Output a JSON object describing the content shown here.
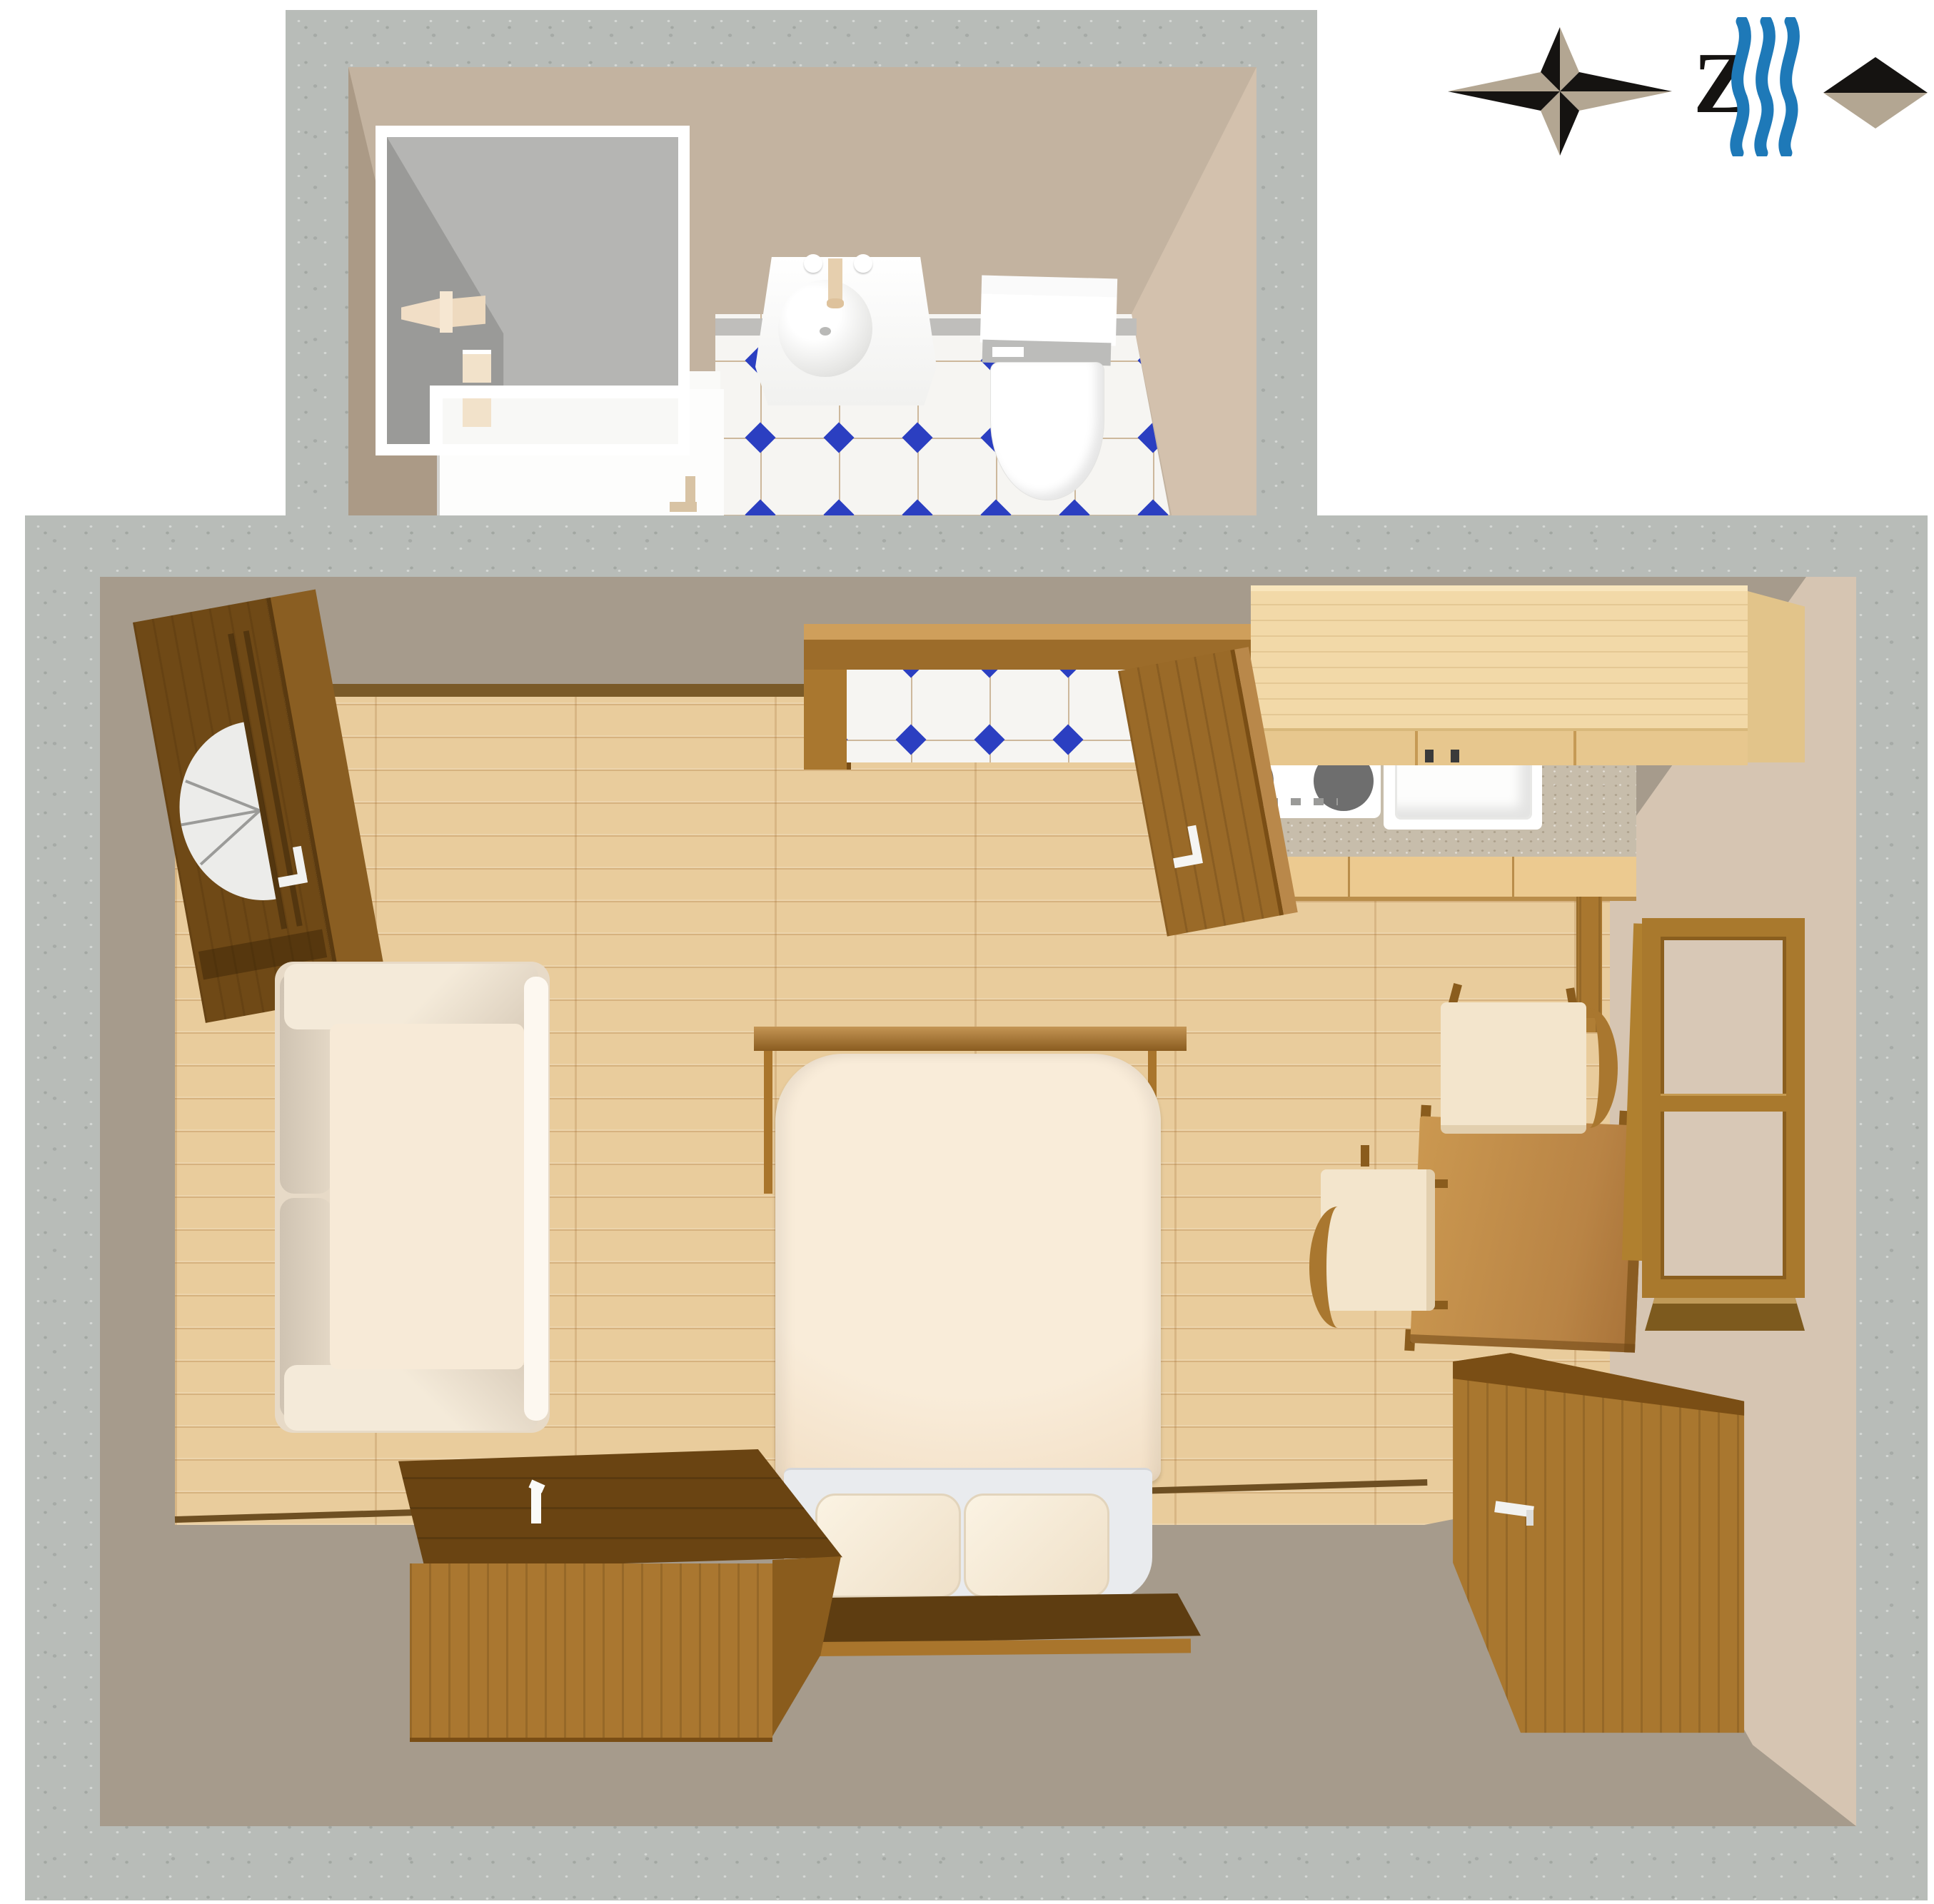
{
  "meta": {
    "type": "3d-floor-plan",
    "description": "Top-down 3D rendered floor plan of a studio apartment: bathroom at top with shower cabin, washbasin and toilet on blue-diamond tiles; main room with entrance door, sofa, double bed, kitchenette with stove and sink, dining table with two chairs, window and chests of drawers"
  },
  "indicators": {
    "compass": {
      "label": "Z",
      "icon": "compass-rose-icon"
    },
    "sea_direction": {
      "icon": "waves-icon"
    },
    "orientation_marker": {
      "icon": "diamond-icon"
    }
  },
  "rooms": {
    "bathroom": {
      "name": "bathroom",
      "floor": "white tiles with blue diamond accents",
      "fixtures": [
        "shower-cabin",
        "shower-head",
        "soap-shelves",
        "washbasin",
        "faucet",
        "toilet",
        "open-white-door"
      ]
    },
    "main_room": {
      "name": "studio room",
      "floor": "light oak laminate",
      "furniture": [
        "entrance-door",
        "sofa",
        "double-bed",
        "headboard",
        "pillows",
        "foot-bench",
        "chest-of-drawers-left",
        "kitchen-upper-cabinets",
        "kitchen-counter",
        "stove",
        "kitchen-sink",
        "interior-door-open",
        "dining-table",
        "chair-top",
        "chair-left",
        "window",
        "chest-of-drawers-right"
      ]
    }
  },
  "colors": {
    "concrete_wall": "#b8bcb8",
    "inner_wall_taupe": "#a69b8c",
    "inner_wall_beige": "#d6c5b2",
    "bathroom_wall": "#c3b3a0",
    "wood_floor": "#e9cc9c",
    "tile_white": "#f6f5f2",
    "tile_blue": "#2b3fc1",
    "dark_wood": "#6f4916",
    "mid_wood": "#a9772f",
    "cabinet_light_wood": "#f2d9a8",
    "fixture_white": "#ffffff",
    "fabric_cream": "#f7ead7",
    "wave_blue": "#1e79b8",
    "compass_black": "#151311",
    "compass_tan": "#b3a692"
  }
}
